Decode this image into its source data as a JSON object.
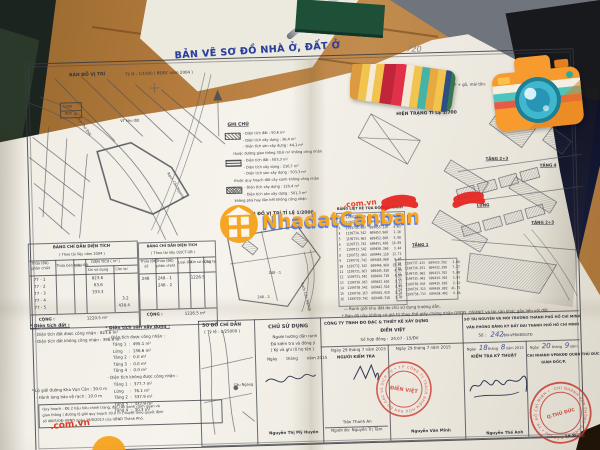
{
  "photo": {
    "handwritten_page_number": "720",
    "desk_card_fragments": [
      "ường",
      "w: 09",
      "gma"
    ]
  },
  "watermark": {
    "brand_a": "Nhadat",
    "brand_b": "Canban",
    "domain": ".com.vn",
    "corner_domain": ".com.vn"
  },
  "doc": {
    "title": "BẢN VẼ SƠ ĐỒ NHÀ Ở, ĐẤT Ở",
    "map1000": {
      "heading": "BẢN ĐỒ VỊ TRÍ",
      "scale": "Tỷ lệ : 1/1000 ( BĐĐC năm 2004 )",
      "ratio_top": "1199",
      "ratio_bottom": "800",
      "street": "Đ. Chợ Thủ Đức",
      "stream": "Rạch Cầu Ngang",
      "plot_label": "VT khu đất"
    },
    "legend": {
      "heading": "GHI CHÚ",
      "g1": [
        "- Diện tích đất : 50,6 m²",
        "- Diện tích xây dựng : 36,4 m²",
        "- Diện tích sàn xây dựng : 44,1 m²",
        "thuộc đường giao thông 30,6 m² không công nhận"
      ],
      "g2": [
        "- Diện tích đất : 503,3 m²",
        "- Diện tích xây dựng : 216,7 m²",
        "- Diện tích sàn xây dựng : 503,3 m²",
        "thuộc quy hoạch đất cây xanh không công nhận"
      ],
      "g3": [
        "- Diện tích xây dựng : 120,4 m²",
        "- Diện tích sàn xây dựng : 501,3 m²",
        "không phá hay liên kết không công nhận"
      ]
    },
    "info": [
      "Linh Đông - Q. Thủ Đức",
      "gạch, vách tôn, sàn BTCT + gỗ, mái tôn."
    ],
    "hientrang": {
      "heading": "HIỆN TRẠNG TỈ LỆ 1/700",
      "floor_1": "TẦNG 2+3",
      "floor_2": "TẦNG 4",
      "floor_3": "LỬNG",
      "floor_4": "TẦNG 2+3",
      "floor_5": "TẦNG 1"
    },
    "map2000": {
      "heading": "BẢN ĐỒ VỊ TRÍ TỈ LỆ 1/2000",
      "stream": "Rạch Cầu Ngang",
      "parcel_1": "248 - 1",
      "parcel_2": "248 - 2"
    },
    "coords": {
      "title": "BẢNG LIỆT KÊ TỌA ĐỘ GÓC RANH",
      "left_rows": [
        "1   1199736.120  609457.491  10.93",
        "2   1199735.063  609456.177   4.60",
        "3   1199734.963  609455.110   4.63",
        "4   1199734.342  609453.960   1.16",
        "5   1199733.963  609452.660   5.98",
        "6   1199733.742  609451.460  14.89",
        "7   1199733.542  609450.260   3.44",
        "8   1199732.963  609449.110  12.71",
        "9   1199732.742  609448.060   9.05",
        "10  1199732.342  609446.960  15.91",
        "11  1199731.963  609445.810   4.94",
        "12  1199731.542  609444.710   4.04",
        "13  1199730.963  609443.610   3.12",
        "14  1199730.542  609442.510   3.49",
        "15  1199730.163  609441.410   2.51",
        "16  1199729.742  609440.310   3.47"
      ],
      "right_rows": [
        "19  1199737.433  609433.502   3.04",
        "20  1199736.291  609432.290   7.27",
        "21  1199735.602  609433.702   5.48",
        "22  1199735.942  609434.302   3.43",
        "23  1199738.943  609435.602   2.42",
        "24  1199739.313  609436.802  41.75",
        "25  1199738.713  609438.402   6.04"
      ]
    },
    "footnote_1": "— Ranh giới khu đất do chủ sử dụng trưởng dẫn.",
    "footnote_2": "* Bản đồ này không có giá trị thay thế giấy chứng nhận QSDĐ, QSHNƠ và tài sản khác gắn liền với đất.",
    "bang1": {
      "title": "BẢNG CHỈ DẪN DIỆN TÍCH",
      "subtitle": "( Theo tài liệu năm 2004 )",
      "h_thua": "Thửa (BK)",
      "h_thua2": "phân chiết",
      "h_mau": "Thửa bản màu",
      "h_loai": "Loại đất",
      "h_dt": "DIỆN TÍCH ( m² )",
      "h_xin": "Xin sử dụng",
      "h_con": "Còn lại",
      "r1": "77 - 1",
      "r2": "77 - 2",
      "r3": "77 - 3",
      "r4": "77 - 4",
      "r5": "77 - 5",
      "v1": "823.6",
      "v2": "63.6",
      "v3": "333.3",
      "v4": "3.2",
      "v5": "438.4",
      "cong": "CỘNG :",
      "total": "1220.5 m²"
    },
    "bang2": {
      "title": "BẢNG CHỈ DẪN DIỆN TÍCH",
      "subtitle": "( Theo tài liệu 02/CT-UB )",
      "h_so": "Thửa (BK)",
      "h_so2": "số",
      "h_pc": "Thửa (BK)",
      "h_pc2": "phân chiết",
      "h_loai": "Loại đất",
      "h_xin": "Xin sử dụng",
      "h_con": "Còn lại",
      "r_so": "248",
      "r_pc1": "248 - 1",
      "r_pc2": "248 - 2",
      "v1": "1226.5",
      "cong": "CỘNG :",
      "total": "1226.5 m²"
    },
    "dt_dat": {
      "heading": "* Diện tích đất :",
      "l1": "- Diện tích đất được công nhận : 823.6 m²",
      "l2": "- Diện tích đất không công nhận : 396.9 m²"
    },
    "dt_san": {
      "heading": "* Diện tích sàn xây dựng :",
      "g1_label": "- Diện tích được công nhận :",
      "g1": [
        "Tầng 1  :  495.1 m²",
        "Lửng     :  136.6 m²",
        "Tầng 2  :  0.0 m²",
        "Tầng 3  :  0.0 m²",
        "Tầng 4  :  0.0 m²"
      ],
      "g2_label": "- Diện tích không được công nhận :",
      "g2": [
        "Tầng 1  :  377.7 m²",
        "Lửng     :  76.1 m²",
        "Tầng 2  :  337.9 m²",
        "Tầng 3  :  337.9 m²",
        "Tầng 4  :  30.3 m²"
      ]
    },
    "lo_gioi_1": "* Lộ giới đường Kha Vạn Cân : 30.0 m",
    "lo_gioi_2": "- Hành lang bảo vệ rạch : 10.0 m",
    "quyhoach_1": "Quy hoạch : ĐE 2 hậu hữu chỉnh trang, đất cây xanh cảnh quan và",
    "quyhoach_2": "giao thông ( đường lộ giới quy hoạch 30.0 m ) duyệt theo quyết định",
    "quyhoach_3": "số 4665/QĐ-UBND ngày 19/8/2013 của UBND Thành Phố.",
    "sodo": {
      "heading": "SƠ ĐỒ CHỈ DẪN",
      "scale": "( Tỷ lệ : 1/25000 )",
      "label": "Cầu Ngang"
    },
    "chusd": {
      "heading": "CHỦ SỬ DỤNG",
      "l1": "Người hướng dẫn ranh",
      "l2": "Đã kiểm tra và đồng ý",
      "l3": "( Ký và ghi rõ họ tên )",
      "date": "Ngày       tháng       năm 2015",
      "name": "Nguyễn Thị Mỹ Huyền"
    },
    "congty": {
      "l1": "CÔNG TY TNHH ĐO ĐẠC & THIẾT KẾ XÂY DỰNG",
      "l2": "ĐIỀN VIỆT",
      "contract": "Số hợp đồng :  24.07 - 15/ĐV",
      "a_date": "Ngày 29 tháng 7 năm 2015",
      "a_role": "NGƯỜI KIỂM TRA",
      "a_name1": "Trần Thanh An",
      "a_name2": "Người đo: Nguyễn Trị Tâm",
      "b_date": "Ngày 29 tháng 7 năm 2015",
      "b_name": "Nguyễn Văn Minh",
      "stamp_ring": "CÔNG TY TRÁCH NHIỆM HỮU HẠN ĐO ĐẠC VÀ DỊCH VỤ • T.P HỒ CHÍ MINH •",
      "stamp_center": "ĐIỀN VIỆT"
    },
    "sotnmt": {
      "l1": "SỞ TÀI NGUYÊN VÀ MÔI TRƯỜNG THÀNH PHỐ HỒ CHÍ MINH",
      "l2": "VĂN PHÒNG ĐĂNG KÝ ĐẤT ĐAI THÀNH PHỐ HỒ CHÍ MINH",
      "so_label": "Số :",
      "so_value": "242",
      "so_suffix": "/ĐN-VPĐKĐĐGTĐ",
      "a_pre": "Ngày",
      "a_day": "18",
      "a_mid": "tháng",
      "a_month": "8",
      "a_post": "năm 2015",
      "a_role": "KIỂM TRA KỸ THUẬT",
      "a_name": "Nguyễn Thế Anh",
      "b_pre": "Ngày",
      "b_day": "20",
      "b_mid": "tháng",
      "b_month": "9",
      "b_post": "năm",
      "b_role1": "CHI NHÁNH VPĐKĐĐ QUẬN THỦ ĐỨC",
      "b_role2": "GIÁM ĐỐC/P.",
      "b_name": "Lê Xuân",
      "stamp_ring": "CHI NHÁNH VĂN PHÒNG ĐĂNG KÝ ĐẤT ĐAI • TP. HỒ CHÍ MINH •",
      "stamp_center": "Q.THỦ ĐỨC"
    }
  },
  "colors": {
    "title_blue": "#2b3f9e",
    "stamp_red": "#c43a2f",
    "scribble_red": "#e6231f",
    "watermark_orange": "#f6a21c",
    "watermark_link_red": "#e5391f"
  }
}
